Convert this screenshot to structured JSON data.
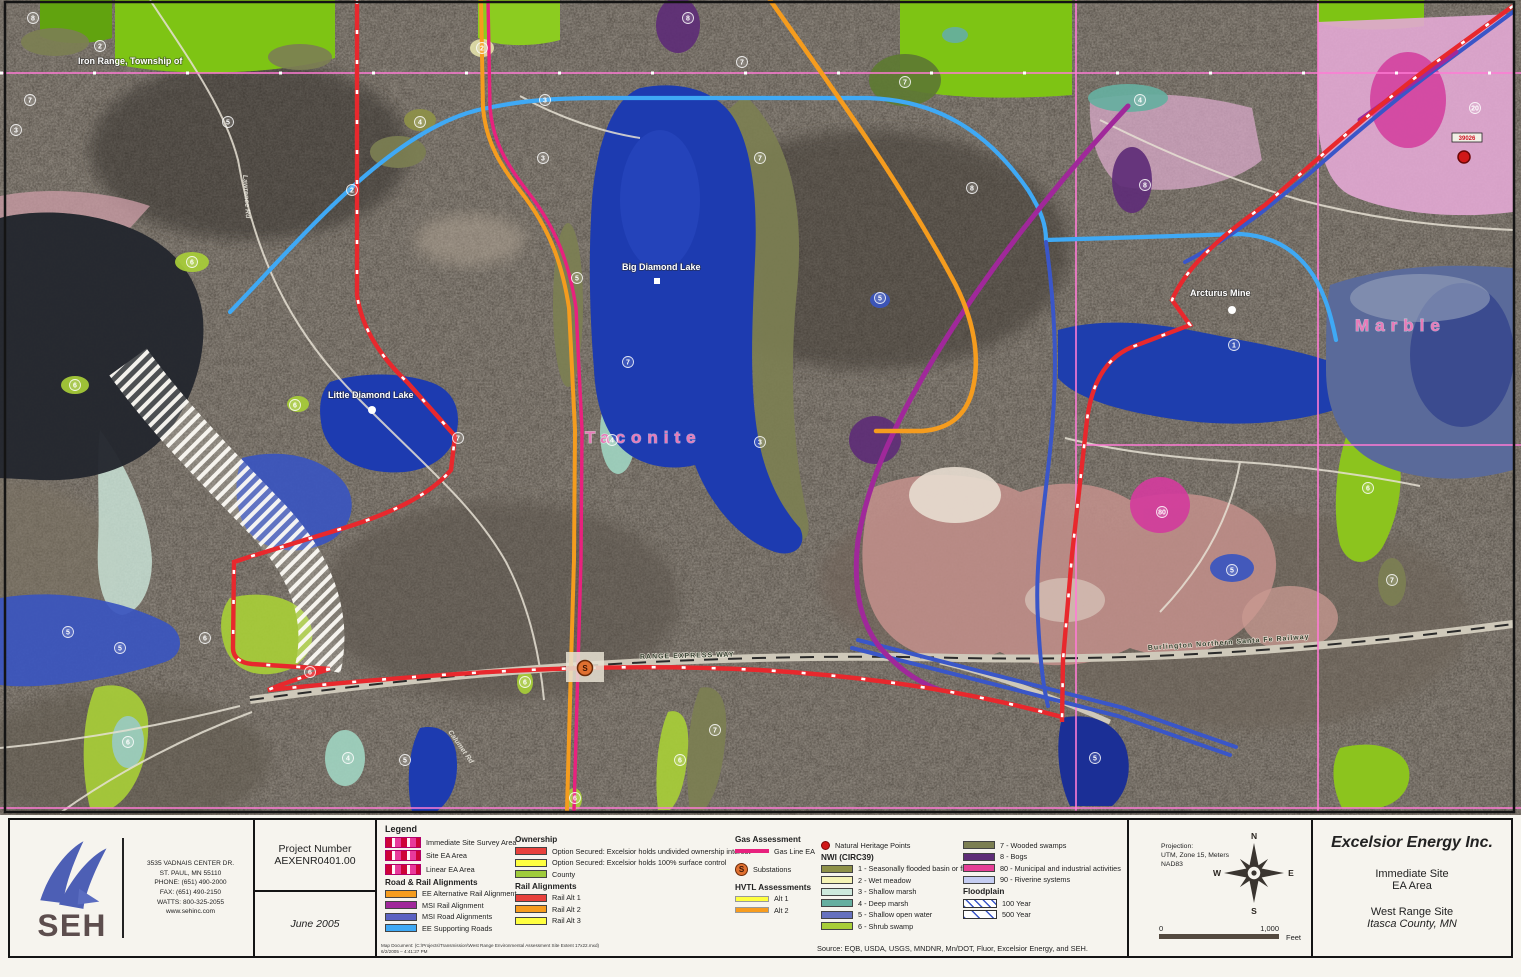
{
  "colors": {
    "ee_alt_rail": "#F59C1E",
    "msi_rail": "#A0289A",
    "msi_road": "#5B62C1",
    "ee_support": "#3FA9F5",
    "own_undivided": "#E8413C",
    "own_surface": "#FFFF40",
    "own_county": "#9FCB3B",
    "rail_alt1": "#E8413C",
    "rail_alt2": "#F79C1E",
    "rail_alt3": "#FFFF40",
    "gas_line": "#E8217E",
    "hvtl_alt1": "#FFFF40",
    "hvtl_alt2": "#F79C1E",
    "nwi1": "#8E9148",
    "nwi2": "#F5F3B5",
    "nwi3": "#CDE9DC",
    "nwi4": "#66AFA0",
    "nwi5": "#6671BE",
    "nwi6": "#A8CE38",
    "nwi7": "#7C7F52",
    "nwi8": "#5E2D77",
    "nwi80": "#E63F96",
    "nwi90": "#C5CDF2",
    "lake_blue": "#1D3BB0",
    "field_green": "#7EC414",
    "survey_pink": "#E8399B"
  },
  "map": {
    "labels": {
      "township": "Iron Range, Township of",
      "big_diamond": "Big Diamond Lake",
      "little_diamond": "Little Diamond Lake",
      "taconite": "Taconite",
      "marble": "Marble",
      "arcturus": "Arcturus Mine",
      "range_expwy": "RANGE EXPRESS WAY",
      "bnsf": "Burlington Northern Santa Fe Railway",
      "road_vertical": "Lawrence Rd",
      "road_diagonal": "Calumet Rd",
      "heritage_point": "39026",
      "substation": "S"
    },
    "markers": [
      {
        "x": 33,
        "y": 18,
        "t": "8"
      },
      {
        "x": 30,
        "y": 100,
        "t": "7"
      },
      {
        "x": 16,
        "y": 130,
        "t": "3"
      },
      {
        "x": 100,
        "y": 46,
        "t": "2"
      },
      {
        "x": 228,
        "y": 122,
        "t": "5"
      },
      {
        "x": 352,
        "y": 190,
        "t": "2"
      },
      {
        "x": 420,
        "y": 122,
        "t": "4"
      },
      {
        "x": 545,
        "y": 100,
        "t": "3"
      },
      {
        "x": 688,
        "y": 18,
        "t": "8"
      },
      {
        "x": 742,
        "y": 62,
        "t": "7"
      },
      {
        "x": 543,
        "y": 158,
        "t": "3"
      },
      {
        "x": 577,
        "y": 278,
        "t": "5"
      },
      {
        "x": 612,
        "y": 440,
        "t": "4"
      },
      {
        "x": 628,
        "y": 362,
        "t": "7"
      },
      {
        "x": 972,
        "y": 188,
        "t": "8"
      },
      {
        "x": 880,
        "y": 298,
        "t": "5"
      },
      {
        "x": 1140,
        "y": 100,
        "t": "4"
      },
      {
        "x": 1145,
        "y": 185,
        "t": "8"
      },
      {
        "x": 1234,
        "y": 345,
        "t": "1"
      },
      {
        "x": 1162,
        "y": 512,
        "t": "80"
      },
      {
        "x": 1475,
        "y": 108,
        "t": "20"
      },
      {
        "x": 1368,
        "y": 488,
        "t": "6"
      },
      {
        "x": 1392,
        "y": 580,
        "t": "7"
      },
      {
        "x": 1232,
        "y": 570,
        "t": "5"
      },
      {
        "x": 120,
        "y": 648,
        "t": "5"
      },
      {
        "x": 68,
        "y": 632,
        "t": "5"
      },
      {
        "x": 205,
        "y": 638,
        "t": "6"
      },
      {
        "x": 310,
        "y": 672,
        "t": "6"
      },
      {
        "x": 348,
        "y": 758,
        "t": "4"
      },
      {
        "x": 128,
        "y": 742,
        "t": "6"
      },
      {
        "x": 405,
        "y": 760,
        "t": "5"
      },
      {
        "x": 525,
        "y": 682,
        "t": "6"
      },
      {
        "x": 575,
        "y": 798,
        "t": "6"
      },
      {
        "x": 680,
        "y": 760,
        "t": "6"
      },
      {
        "x": 715,
        "y": 730,
        "t": "7"
      },
      {
        "x": 295,
        "y": 405,
        "t": "6"
      },
      {
        "x": 192,
        "y": 262,
        "t": "6"
      },
      {
        "x": 75,
        "y": 385,
        "t": "6"
      },
      {
        "x": 905,
        "y": 82,
        "t": "7"
      },
      {
        "x": 1095,
        "y": 758,
        "t": "5"
      },
      {
        "x": 760,
        "y": 158,
        "t": "7"
      },
      {
        "x": 458,
        "y": 438,
        "t": "7"
      },
      {
        "x": 482,
        "y": 48,
        "t": "2"
      },
      {
        "x": 760,
        "y": 442,
        "t": "3"
      }
    ]
  },
  "seh": {
    "name": "SEH",
    "address_line1": "3535 VADNAIS CENTER DR.",
    "address_line2": "ST. PAUL, MN 55110",
    "address_line3": "PHONE: (651) 490-2000",
    "address_line4": "FAX: (651) 490-2150",
    "address_line5": "WATTS: 800-325-2055",
    "url": "www.sehinc.com"
  },
  "project": {
    "label": "Project Number",
    "number": "AEXENR0401.00",
    "date": "June 2005"
  },
  "legend": {
    "title": "Legend",
    "areas": {
      "items": [
        {
          "label": "Immediate Site Survey Area"
        },
        {
          "label": "Site EA Area"
        },
        {
          "label": "Linear EA Area"
        }
      ]
    },
    "road_rail": {
      "title": "Road & Rail Alignments",
      "items": [
        {
          "label": "EE Alternative Rail Alignment"
        },
        {
          "label": "MSI Rail Alignment"
        },
        {
          "label": "MSI Road Alignments"
        },
        {
          "label": "EE Supporting Roads"
        }
      ]
    },
    "ownership": {
      "title": "Ownership",
      "items": [
        {
          "label": "Option Secured: Excelsior holds undivided ownership interest"
        },
        {
          "label": "Option Secured: Excelsior holds 100% surface control"
        },
        {
          "label": "County"
        }
      ]
    },
    "rail_alts": {
      "title": "Rail Alignments",
      "items": [
        {
          "label": "Rail Alt 1"
        },
        {
          "label": "Rail Alt 2"
        },
        {
          "label": "Rail Alt 3"
        }
      ]
    },
    "gas": {
      "title": "Gas Assessment",
      "line_label": "Gas Line EA",
      "sub_label": "Substations"
    },
    "hvtl": {
      "title": "HVTL Assessments",
      "items": [
        {
          "label": "Alt 1"
        },
        {
          "label": "Alt 2"
        }
      ]
    },
    "heritage_label": "Natural Heritage Points",
    "nwi": {
      "title": "NWI (CIRC39)",
      "items": [
        {
          "label": "1 - Seasonally flooded basin or flat"
        },
        {
          "label": "2 - Wet meadow"
        },
        {
          "label": "3 - Shallow marsh"
        },
        {
          "label": "4 - Deep marsh"
        },
        {
          "label": "5 - Shallow open water"
        },
        {
          "label": "6 - Shrub swamp"
        }
      ]
    },
    "nwi_right": {
      "items": [
        {
          "label": "7 - Wooded swamps"
        },
        {
          "label": "8 - Bogs"
        },
        {
          "label": "80 - Municipal and industrial activities"
        },
        {
          "label": "90 - Riverine systems"
        }
      ]
    },
    "floodplain": {
      "title": "Floodplain",
      "items": [
        {
          "label": "100 Year"
        },
        {
          "label": "500 Year"
        }
      ]
    },
    "source": "Source: EQB, USDA, USGS, MNDNR, Mn/DOT, Fluor, Excelsior Energy, and SEH.",
    "map_doc_line1": "Map Document: (C:\\Projects\\Transmission\\West Range Environmental Assessment Site Extent 17x22.mxd)",
    "map_doc_line2": "6/2/2005 – 4:41:27 PM"
  },
  "projection": {
    "line1": "Projection:",
    "line2": "UTM, Zone 15, Meters",
    "line3": "NAD83",
    "compass": {
      "n": "N",
      "e": "E",
      "s": "S",
      "w": "W"
    },
    "scale": {
      "zero": "0",
      "max": "1,000",
      "unit": "Feet"
    }
  },
  "title_block": {
    "company": "Excelsior Energy Inc.",
    "site_line1": "Immediate Site",
    "site_line2": "EA Area",
    "range_line1": "West Range Site",
    "range_line2": "Itasca County, MN"
  }
}
